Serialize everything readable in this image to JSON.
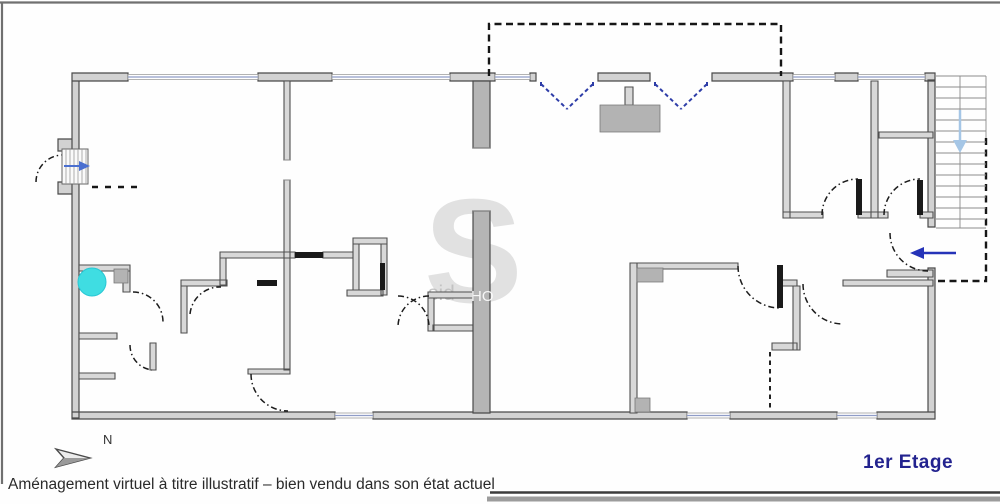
{
  "plan": {
    "floor_label": "1er Etage",
    "north_label": "N",
    "caption": "Aménagement virtuel à titre illustratif – bien vendu dans son état actuel",
    "watermark": {
      "letter": "S",
      "small_text": "sid",
      "wall_text": "HO"
    },
    "colors": {
      "wall_fill": "#d2d2d2",
      "wall_stroke": "#4a4a4a",
      "interior_wall_fill": "#d8d8d8",
      "poche_fill": "#b5b5b5",
      "window_blue": "#8f9cc7",
      "french_door_blue": "#2e3da8",
      "entry_arrow_blue": "#2533b8",
      "stair_arrow_light_blue": "#a5c6e6",
      "internal_stair_arrow_blue": "#4a6fd0",
      "marker_cyan": "#3fdde2",
      "floor_label_navy": "#23238f",
      "dash_color": "#161616",
      "caption_color": "#2a2a2a"
    }
  }
}
